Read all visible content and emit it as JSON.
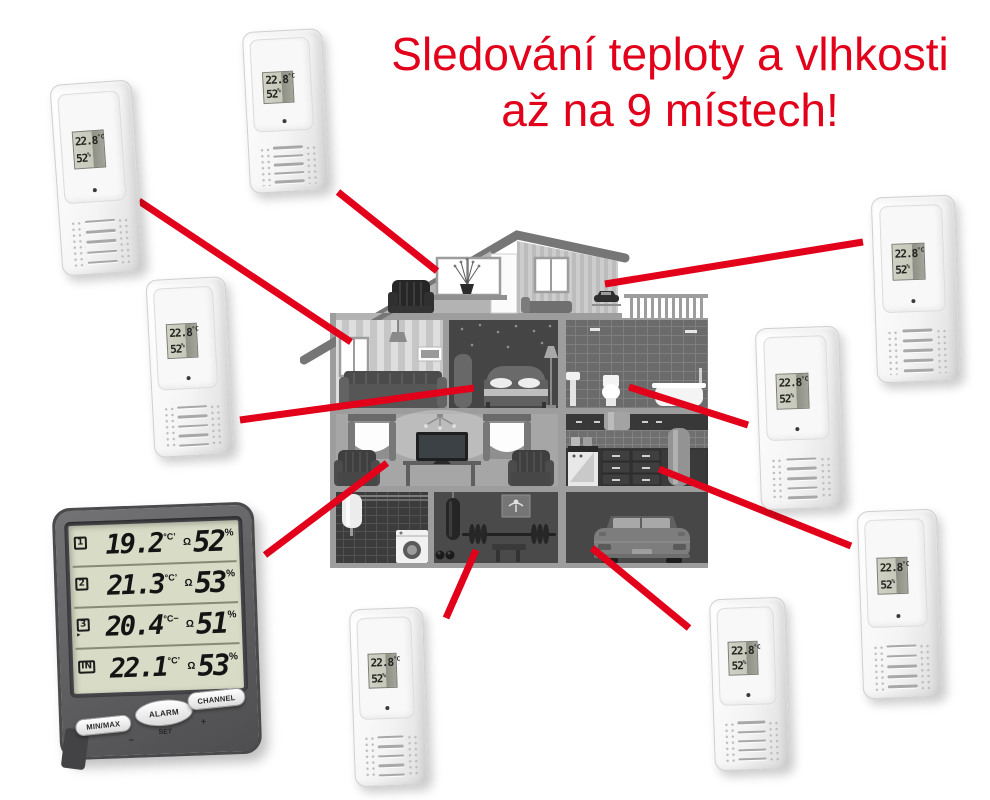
{
  "title": {
    "line1": "Sledování teploty a vlhkosti",
    "line2": "až na 9 místech!"
  },
  "colors": {
    "accent": "#e2001a",
    "console_body": "#5e5e60",
    "console_lcd": "#d8dbc6",
    "sensor_white": "#f4f4f4",
    "house_gray": "#9d9d9d"
  },
  "console": {
    "rows": [
      {
        "channel": "1",
        "marker": "",
        "temp": "19.2",
        "unit": "°C",
        "trend": "’",
        "hum_icon": "Ω",
        "humidity": "52",
        "hum_unit": "%"
      },
      {
        "channel": "2",
        "marker": "",
        "temp": "21.3",
        "unit": "°C",
        "trend": "’",
        "hum_icon": "Ω",
        "humidity": "53",
        "hum_unit": "%"
      },
      {
        "channel": "3",
        "marker": "▸",
        "temp": "20.4",
        "unit": "°C",
        "trend": "−",
        "hum_icon": "Ω",
        "humidity": "51",
        "hum_unit": "%"
      },
      {
        "channel": "IN",
        "marker": "",
        "temp": "22.1",
        "unit": "°C",
        "trend": "’",
        "hum_icon": "Ω",
        "humidity": "53",
        "hum_unit": "%"
      }
    ],
    "buttons": {
      "minmax": "MIN/MAX",
      "alarm": "ALARM",
      "channel": "CHANNEL"
    },
    "labels": {
      "set": "SET",
      "minus": "−",
      "plus": "+"
    }
  },
  "sensors": [
    {
      "temp": "22.8",
      "unit": "°C",
      "humidity": "52",
      "hum_unit": "%"
    },
    {
      "temp": "22.8",
      "unit": "°C",
      "humidity": "52",
      "hum_unit": "%"
    },
    {
      "temp": "22.8",
      "unit": "°C",
      "humidity": "52",
      "hum_unit": "%"
    },
    {
      "temp": "22.8",
      "unit": "°C",
      "humidity": "52",
      "hum_unit": "%"
    },
    {
      "temp": "22.8",
      "unit": "°C",
      "humidity": "52",
      "hum_unit": "%"
    },
    {
      "temp": "22.8",
      "unit": "°C",
      "humidity": "52",
      "hum_unit": "%"
    },
    {
      "temp": "22.8",
      "unit": "°C",
      "humidity": "52",
      "hum_unit": "%"
    },
    {
      "temp": "22.8",
      "unit": "°C",
      "humidity": "52",
      "hum_unit": "%"
    }
  ]
}
